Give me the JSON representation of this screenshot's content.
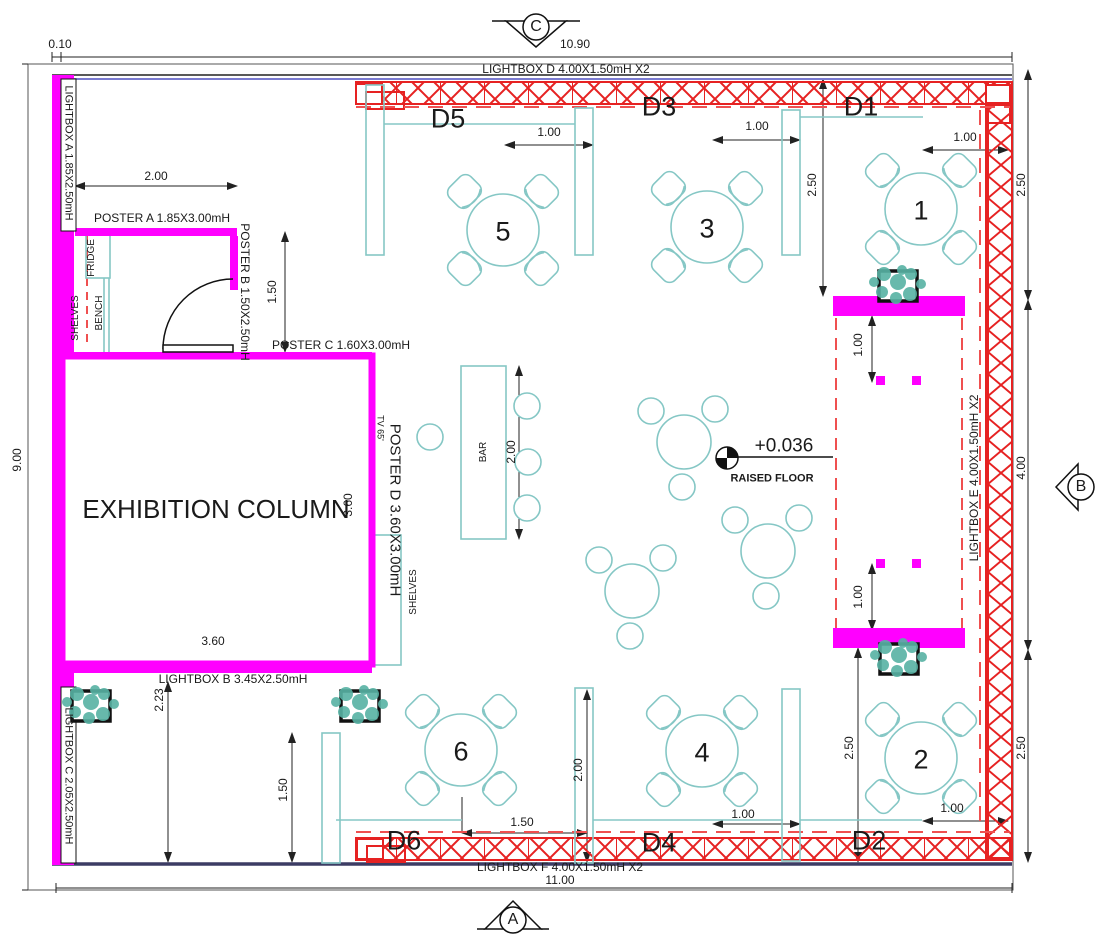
{
  "markers": {
    "top": "C",
    "right": "B",
    "bottom": "A"
  },
  "stands": {
    "d1": "D1",
    "d2": "D2",
    "d3": "D3",
    "d4": "D4",
    "d5": "D5",
    "d6": "D6"
  },
  "tables": {
    "t1": "1",
    "t2": "2",
    "t3": "3",
    "t4": "4",
    "t5": "5",
    "t6": "6"
  },
  "rooms": {
    "exhibition_column": "EXHIBITION COLUMN",
    "bar": "BAR",
    "shelves_left": "SHELVES",
    "bench": "BENCH",
    "fridge": "FRIDGE",
    "shelves_right": "SHELVES",
    "tv": "TV 65'"
  },
  "fixtures": {
    "lightbox_a": "LIGHTBOX A 1.85X2.50mH",
    "lightbox_b": "LIGHTBOX B 3.45X2.50mH",
    "lightbox_c": "LIGHTBOX C 2.05X2.50mH",
    "lightbox_d": "LIGHTBOX D 4.00X1.50mH X2",
    "lightbox_e": "LIGHTBOX E 4.00X1.50mH X2",
    "lightbox_f": "LIGHTBOX F 4.00X1.50mH X2",
    "poster_a": "POSTER A 1.85X3.00mH",
    "poster_b": "POSTER B 1.50X2.50mH",
    "poster_c": "POSTER C 1.60X3.00mH",
    "poster_d": "POSTER D 3.60X3.00mH"
  },
  "level": {
    "value": "+0.036",
    "label": "RAISED FLOOR"
  },
  "dims": {
    "d010": "0.10",
    "d100": "1.00",
    "d150": "1.50",
    "d200": "2.00",
    "d223": "2.23",
    "d250": "2.50",
    "d360": "3.60",
    "d400": "4.00",
    "d900": "9.00",
    "d1090": "10.90",
    "d1100": "11.00"
  },
  "colors": {
    "wall_magenta": "#FF00FF",
    "truss_red": "#E62222",
    "dashed_red": "#EF5050",
    "furniture_teal": "#85C7C5",
    "plant_green": "#57B2A4",
    "wall_blue": "#7B7BD0",
    "line_dark": "#1A1A1A"
  }
}
